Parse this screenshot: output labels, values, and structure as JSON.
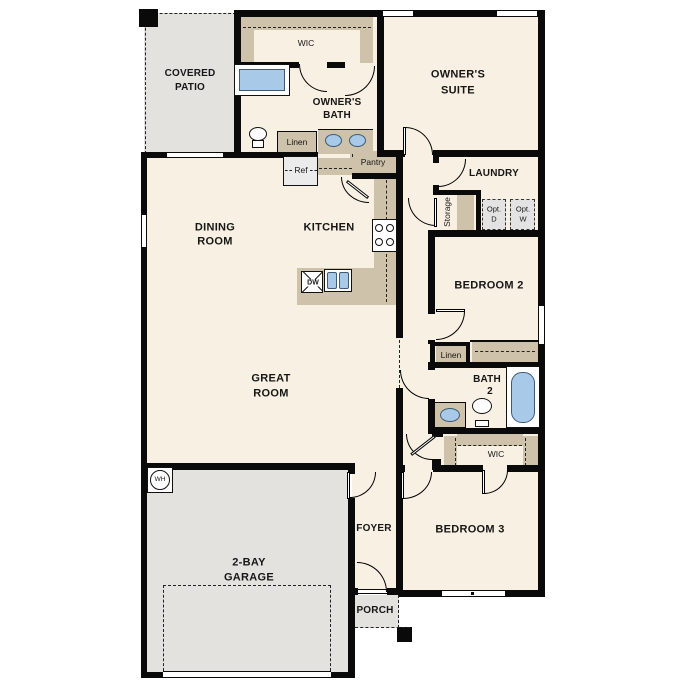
{
  "title": "single-story floor plan",
  "colors": {
    "floor": "#f8f0e3",
    "outdoor": "#e3e2df",
    "casework": "#cfc2aa",
    "fixture_blue": "#a9c9e9",
    "wall": "#0a0a0a"
  },
  "rooms": {
    "covered_patio": {
      "l1": "COVERED",
      "l2": "PATIO"
    },
    "owners_wic": {
      "label": "WIC"
    },
    "owners_bath": {
      "l1": "OWNER'S",
      "l2": "BATH"
    },
    "owners_suite": {
      "l1": "OWNER'S",
      "l2": "SUITE"
    },
    "dining": {
      "l1": "DINING",
      "l2": "ROOM"
    },
    "kitchen": {
      "label": "KITCHEN"
    },
    "laundry": {
      "label": "LAUNDRY"
    },
    "storage": {
      "label": "Storage"
    },
    "bedroom2": {
      "label": "BEDROOM 2"
    },
    "bath2": {
      "l1": "BATH",
      "l2": "2"
    },
    "wic2": {
      "label": "WIC"
    },
    "great_room": {
      "l1": "GREAT",
      "l2": "ROOM"
    },
    "foyer": {
      "label": "FOYER"
    },
    "bedroom3": {
      "label": "BEDROOM 3"
    },
    "garage": {
      "l1": "2-BAY",
      "l2": "GARAGE"
    },
    "porch": {
      "label": "PORCH"
    }
  },
  "fixtures": {
    "linen1": "Linen",
    "linen2": "Linen",
    "ref": "Ref",
    "pantry": "Pantry",
    "opt_d": {
      "l1": "Opt.",
      "l2": "D"
    },
    "opt_w": {
      "l1": "Opt.",
      "l2": "W"
    },
    "wh": "WH",
    "dw": "DW"
  }
}
